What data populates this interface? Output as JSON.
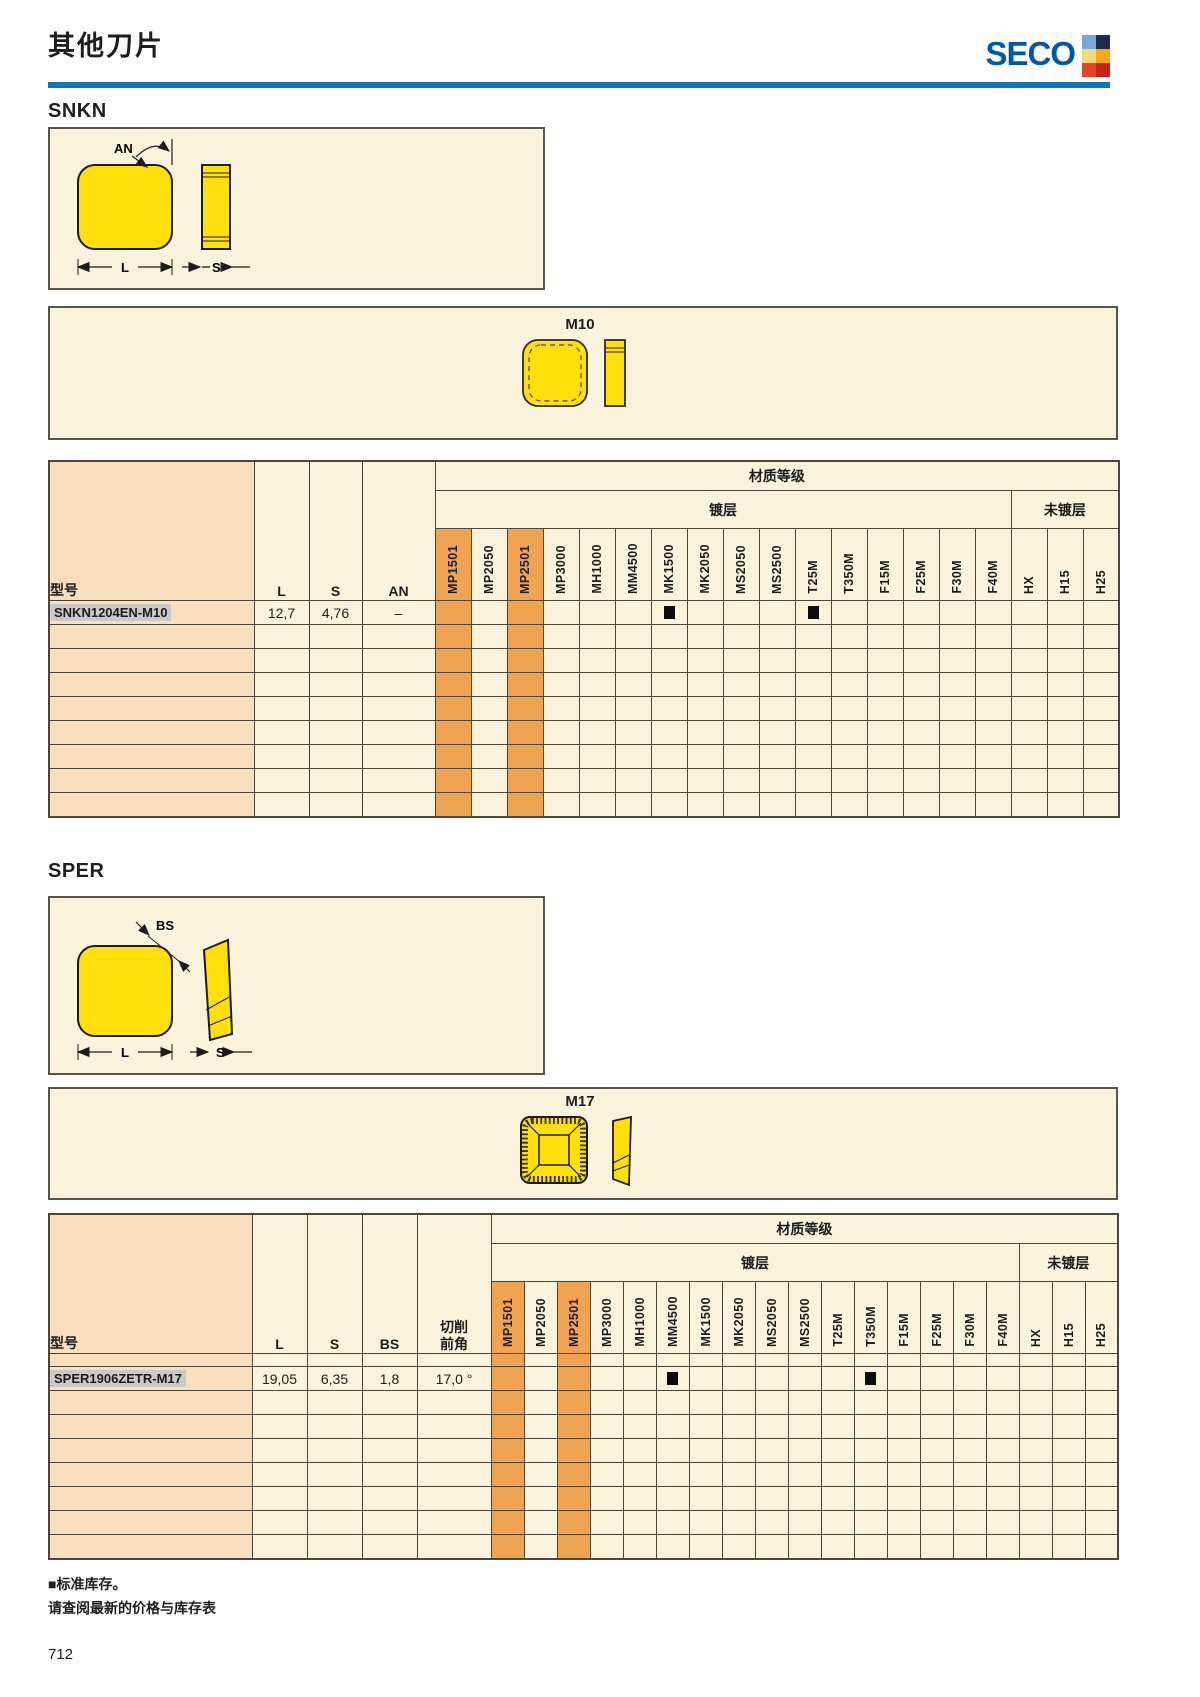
{
  "page": {
    "title": "其他刀片",
    "page_number": "712",
    "footer": {
      "note1": "■标准库存。",
      "note2": "请查阅最新的价格与库存表"
    }
  },
  "logo": {
    "text": "SECO",
    "squares": [
      {
        "name": "light-blue",
        "color": "#74A9D8"
      },
      {
        "name": "dark-navy",
        "color": "#1E2A4A"
      },
      {
        "name": "pale-yellow",
        "color": "#F2DC7A"
      },
      {
        "name": "amber",
        "color": "#F5A81C"
      },
      {
        "name": "red",
        "color": "#E4432C"
      },
      {
        "name": "dark-red",
        "color": "#C22418"
      }
    ]
  },
  "colors": {
    "seco_blue": "#0058A8",
    "rule_blue": "#1173B9",
    "panel_cream": "#FBF3DC",
    "model_col_peach": "#F8E0BE",
    "highlight_orange": "#F0A452",
    "insert_yellow": "#FFE00A",
    "model_highlight_gray": "#C9C9C9",
    "stock_black": "#0c0c0c"
  },
  "sections": [
    {
      "name": "SNKN",
      "diagram": {
        "angle_label": "AN",
        "length_label": "L",
        "thickness_label": "S"
      },
      "chipbreaker": {
        "name": "M10"
      },
      "table": {
        "model_label": "型号",
        "dim_columns": [
          "L",
          "S",
          "AN"
        ],
        "group_label": "材质等级",
        "coated_label": "镀层",
        "uncoated_label": "未镀层",
        "grades_coated": [
          "MP1501",
          "MP2050",
          "MP2501",
          "MP3000",
          "MH1000",
          "MM4500",
          "MK1500",
          "MK2050",
          "MS2050",
          "MS2500",
          "T25M",
          "T350M",
          "F15M",
          "F25M",
          "F30M",
          "F40M"
        ],
        "grades_uncoated": [
          "HX",
          "H15",
          "H25"
        ],
        "highlighted_grades": [
          "MP1501",
          "MP2501"
        ],
        "thin_row": false,
        "empty_rows": 8,
        "rows": [
          {
            "model": "SNKN1204EN-M10",
            "dims": [
              "12,7",
              "4,76",
              "–"
            ],
            "stock": [
              "MK1500",
              "T25M"
            ]
          }
        ]
      }
    },
    {
      "name": "SPER",
      "diagram": {
        "angle_label": "BS",
        "length_label": "L",
        "thickness_label": "S"
      },
      "chipbreaker": {
        "name": "M17"
      },
      "table": {
        "model_label": "型号",
        "dim_columns": [
          "L",
          "S",
          "BS",
          "切削\n前角"
        ],
        "group_label": "材质等级",
        "coated_label": "镀层",
        "uncoated_label": "未镀层",
        "grades_coated": [
          "MP1501",
          "MP2050",
          "MP2501",
          "MP3000",
          "MH1000",
          "MM4500",
          "MK1500",
          "MK2050",
          "MS2050",
          "MS2500",
          "T25M",
          "T350M",
          "F15M",
          "F25M",
          "F30M",
          "F40M"
        ],
        "grades_uncoated": [
          "HX",
          "H15",
          "H25"
        ],
        "highlighted_grades": [
          "MP1501",
          "MP2501"
        ],
        "thin_row": true,
        "empty_rows": 7,
        "rows": [
          {
            "model": "SPER1906ZETR-M17",
            "dims": [
              "19,05",
              "6,35",
              "1,8",
              "17,0 °"
            ],
            "stock": [
              "MM4500",
              "T350M"
            ]
          }
        ]
      }
    }
  ]
}
